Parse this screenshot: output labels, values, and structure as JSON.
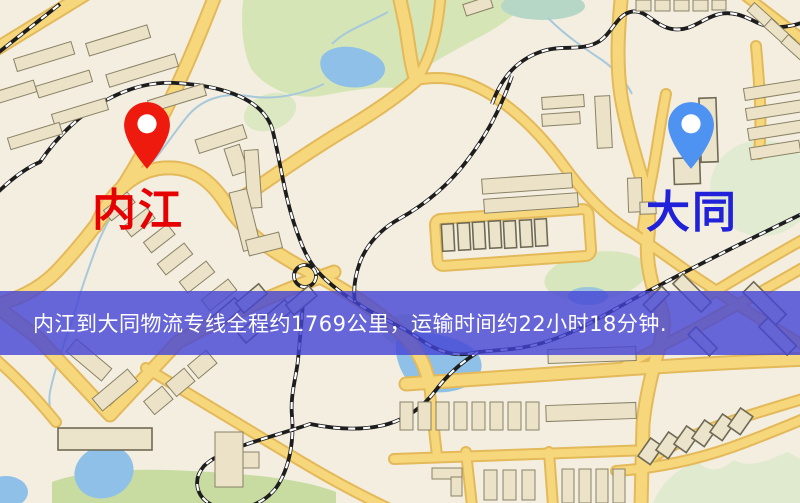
{
  "markers": {
    "origin": {
      "label": "内江",
      "icon": "map-pin-icon",
      "pin_color": "#ee1a0e",
      "label_color": "#e60000"
    },
    "destination": {
      "label": "大同",
      "icon": "map-pin-icon",
      "pin_color": "#4e93f2",
      "label_color": "#2021d8"
    }
  },
  "banner": {
    "text": "内江到大同物流专线全程约1769公里，运输时间约22小时18分钟.",
    "bg_color": "rgba(67,67,214,0.8)",
    "text_color": "#ffffff"
  },
  "route_info": {
    "from_city": "内江",
    "to_city": "大同",
    "service_type": "物流专线",
    "total_distance_km": "1769",
    "transport_time": "22小时18分钟"
  },
  "map_palette": {
    "background": "#f4eee1",
    "road_fill": "#f7d77c",
    "road_casing": "#e3b95a",
    "building": "#ebe2c8",
    "green_area": "#d5e5b5",
    "water": "#8fc1e8",
    "railway": "#1d1d1d"
  }
}
